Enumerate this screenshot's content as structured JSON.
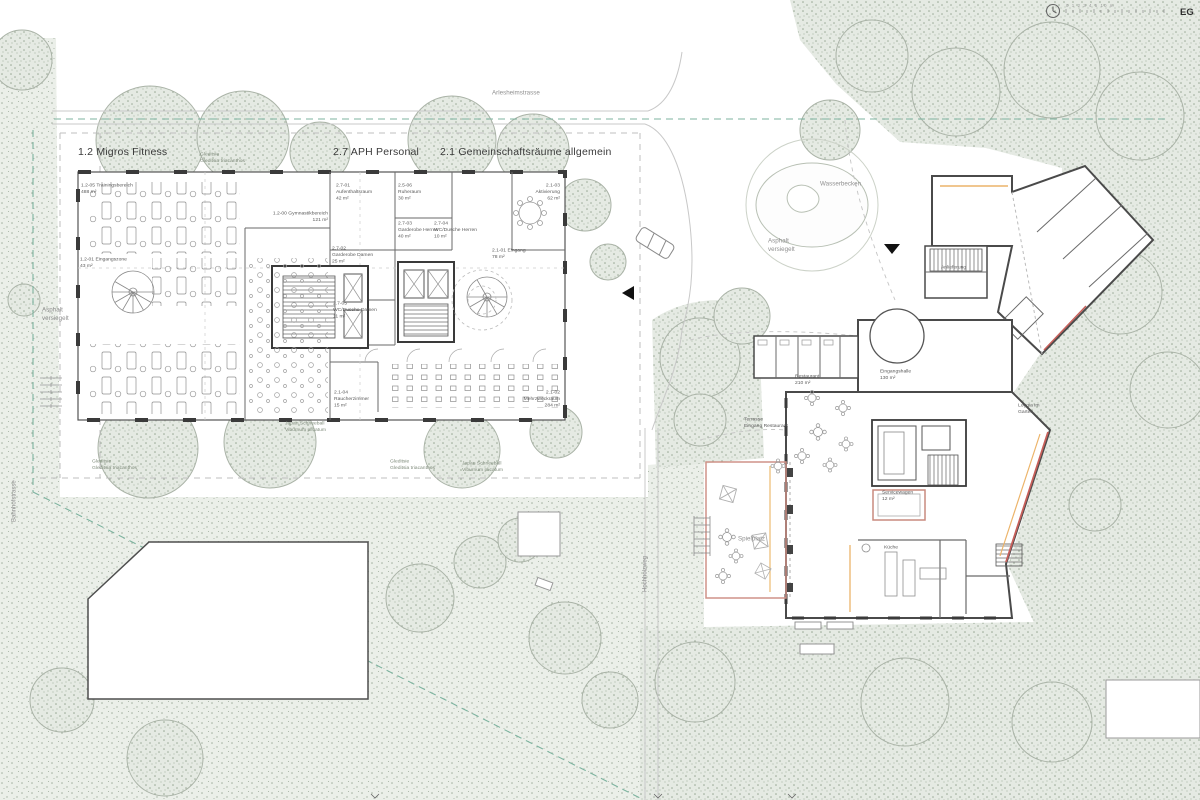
{
  "header": {
    "floor_label": "EG",
    "scale_text": "0 1 2 3 4 5 10 m",
    "clock_icon": "clock"
  },
  "palette": {
    "wall": "#3d3d3d",
    "vegetation": "#e8ece6",
    "accent_red": "#c75f5a",
    "accent_soft_red": "#cf9288",
    "accent_orange": "#ecb46a",
    "boundary_teal": "#7db39f"
  },
  "streets": {
    "top": "Arlesheimstrasse",
    "left": "Bahnhofstrasse",
    "middle": "Hochholzweg"
  },
  "site_labels": {
    "wasserbecken": "Wasserbecken",
    "asphalt_right": "Asphalt\nversiegelt",
    "asphalt_left": "Asphalt\nversiegelt",
    "spielplatz": "Spielplatz",
    "terrasse_restaurant": "Terrasse\nEingang Restaurant",
    "anlieferung": "Anlieferung"
  },
  "tree_labels": {
    "gleditsia_top": "Gleditsie\nGleditsia triacanthos",
    "schneeball_mid": "Japan Schneeball\nViburnum plicatum",
    "gleditsia_bottom_left": "Gleditsie\nGleditsia triacanthos",
    "gleditsia_bottom_mid": "Gleditsie\nGleditsia triacanthos",
    "schneeball_right": "Japan Schneeball\nViburnum plicatum"
  },
  "building_left": {
    "zone_titles": [
      {
        "label": "1.2 Migros Fitness"
      },
      {
        "label": "2.7 APH Personal"
      },
      {
        "label": "2.1 Gemeinschaftsräume allgemein"
      }
    ],
    "rooms": [
      {
        "label": "1.2-05 Trainingsbereich\n488 m²"
      },
      {
        "label": "1.2-00 Gymnastikbereich\n121 m²"
      },
      {
        "label": "1.2-01 Eingangszone\n43 m²"
      },
      {
        "label": "2.7-01\nAufenthaltsraum\n42 m²"
      },
      {
        "label": "2.5-06\nRuheraum\n30 m²"
      },
      {
        "label": "2.1-03\nAktivierung\n62 m²"
      },
      {
        "label": "2.7-03\nGarderobe Herren\n40 m²"
      },
      {
        "label": "2.7-04\nWC/Dusche Herren\n10 m²"
      },
      {
        "label": "2.1-01 Eingang\n78 m²"
      },
      {
        "label": "2.7-02\nGarderobe Damen\n25 m²"
      },
      {
        "label": "2.7-05\nWC/Dusche Damen\n11 m²"
      },
      {
        "label": "2.1-04\nRaucherzimmer\n15 m²"
      },
      {
        "label": "2.1-02\nMehrzweckraum\n284 m²"
      }
    ]
  },
  "building_right": {
    "rooms": [
      {
        "label": "Restaurant\n210 m²"
      },
      {
        "label": "Eingangshalle\n130 m²"
      },
      {
        "label": "Loggia im\nGarten"
      },
      {
        "label": "Servicewagen\n12 m²"
      },
      {
        "label": "Küche"
      }
    ]
  }
}
